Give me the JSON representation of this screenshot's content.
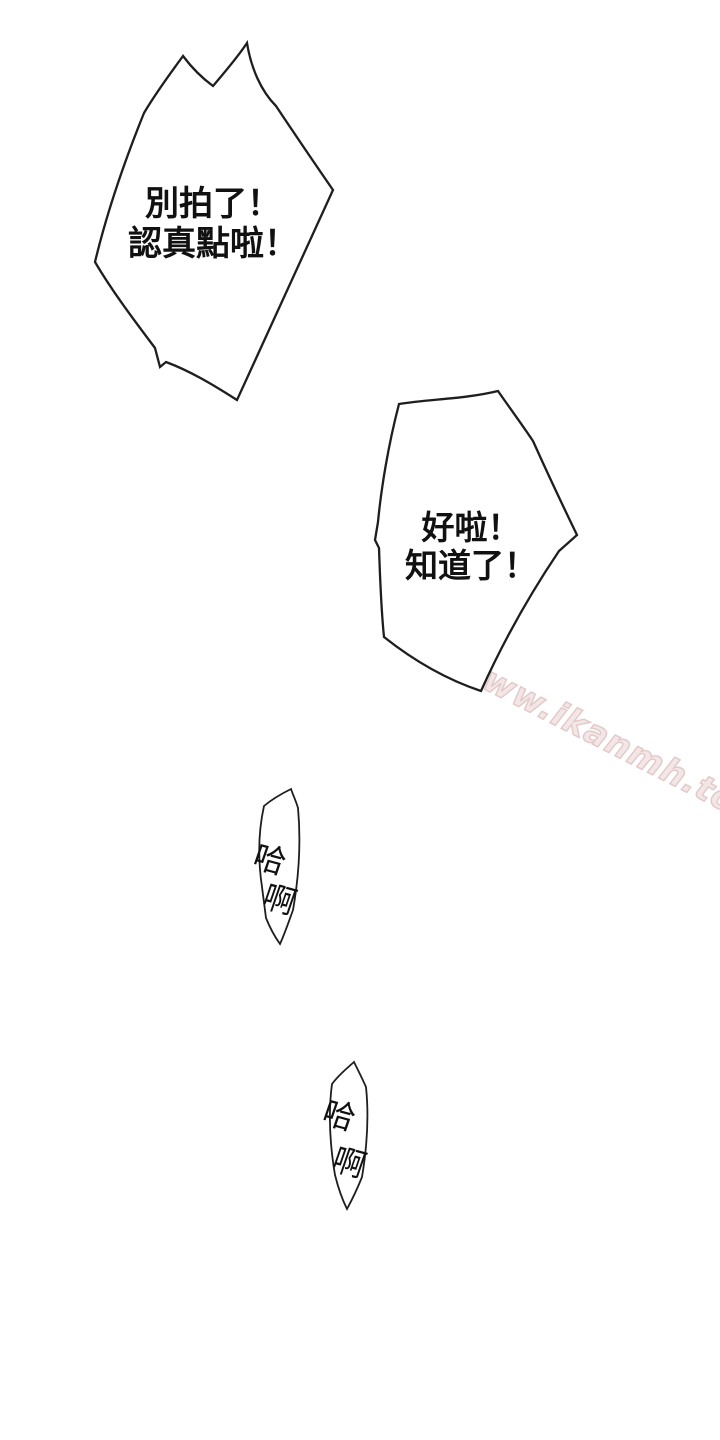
{
  "page": {
    "width": 720,
    "height": 1440,
    "background": "#ffffff"
  },
  "colors": {
    "bubble_outline": "#1e1e1e",
    "bubble_fill": "#ffffff",
    "text": "#111111",
    "watermark": "#e2c6c6"
  },
  "bubbles": {
    "b1": {
      "line1": "別拍了！",
      "line2": "認真點啦！"
    },
    "b2": {
      "line1": "好啦！",
      "line2": "知道了！"
    },
    "sfx1": {
      "char1": "哈",
      "char2": "啊"
    },
    "sfx2": {
      "char1": "哈",
      "char2": "啊"
    }
  },
  "watermark": {
    "text": "www.ikanmh.top"
  }
}
